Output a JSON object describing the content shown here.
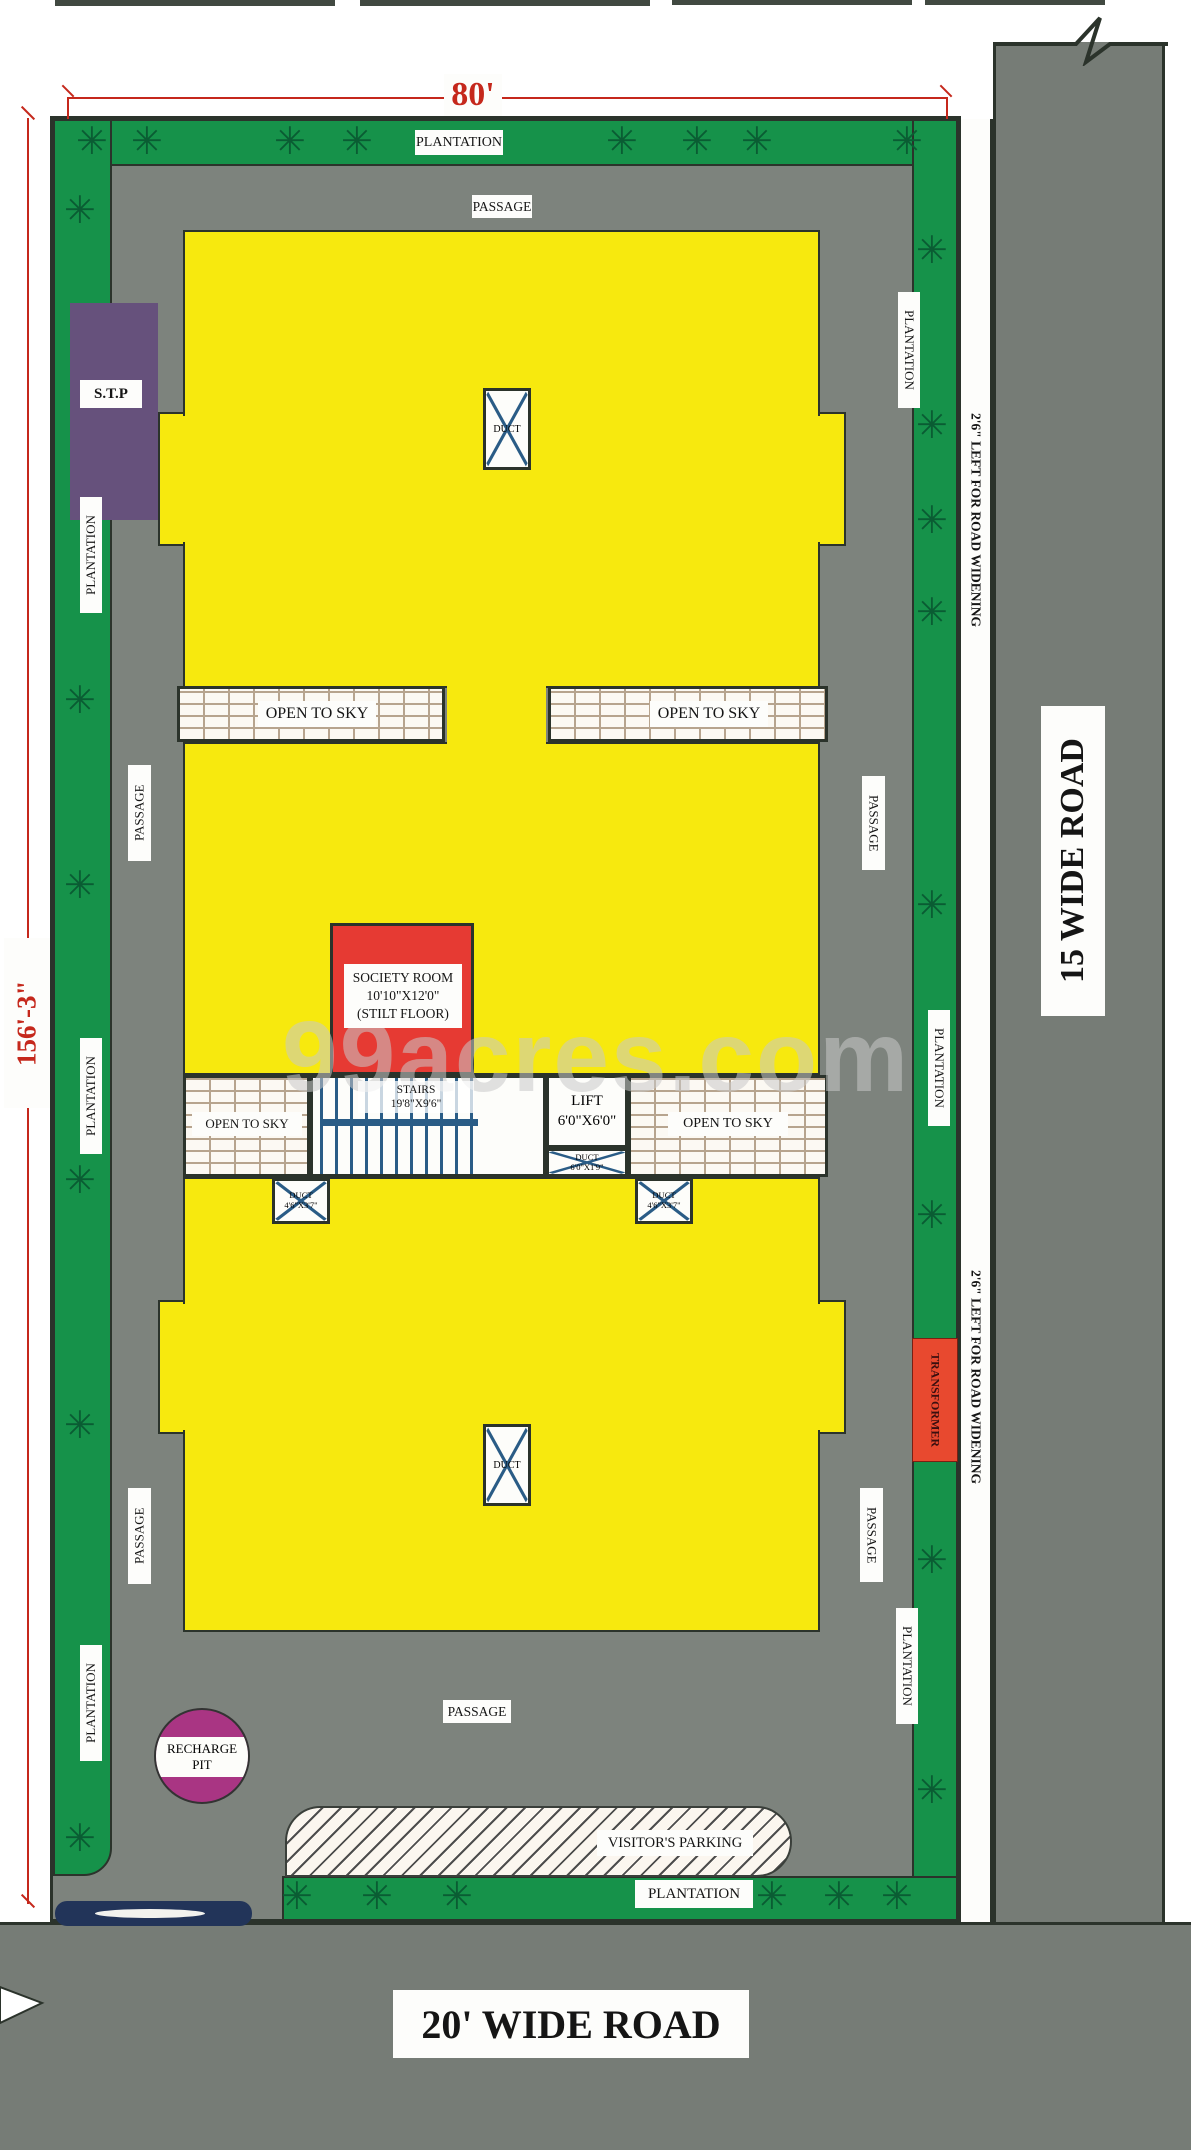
{
  "dimensions": {
    "top": "80'",
    "left": "156'-3\""
  },
  "roads": {
    "right": "15 WIDE ROAD",
    "bottom": "20' WIDE ROAD",
    "widening": "2'6\" LEFT FOR ROAD WIDENING"
  },
  "labels": {
    "plantation": "PLANTATION",
    "passage": "PASSAGE",
    "open_to_sky": "OPEN TO SKY"
  },
  "units": {
    "stp": "S.T.P",
    "society": {
      "l1": "SOCIETY ROOM",
      "l2": "10'10\"X12'0\"",
      "l3": "(STILT FLOOR)"
    },
    "stairs": {
      "l1": "STAIRS",
      "l2": "19'8\"X9'6\""
    },
    "lift": {
      "l1": "LIFT",
      "l2": "6'0\"X6'0\""
    },
    "duct": "DUCT",
    "lift_duct": {
      "l1": "DUCT",
      "l2": "6'0\"X1'9\""
    },
    "small_duct": {
      "l1": "DUCT",
      "l2": "4'6\"X3'7\""
    },
    "transformer": "TRANSFORMER",
    "recharge": {
      "l1": "RECHARGE",
      "l2": "PIT"
    },
    "parking": "VISITOR'S PARKING"
  },
  "watermark": "99acres.com",
  "icons": {
    "plant": "✳"
  },
  "colors": {
    "yellow": "#f7e90e",
    "green": "#16924a",
    "passage_gray": "#7d837d",
    "road_gray": "#767c76",
    "outline": "#2b332b",
    "unit_red": "#e63a33",
    "stp_purple": "#66517c",
    "pit_magenta": "#a93583",
    "duct_blue": "#2a5c86",
    "dimension_red": "#c5281c"
  }
}
